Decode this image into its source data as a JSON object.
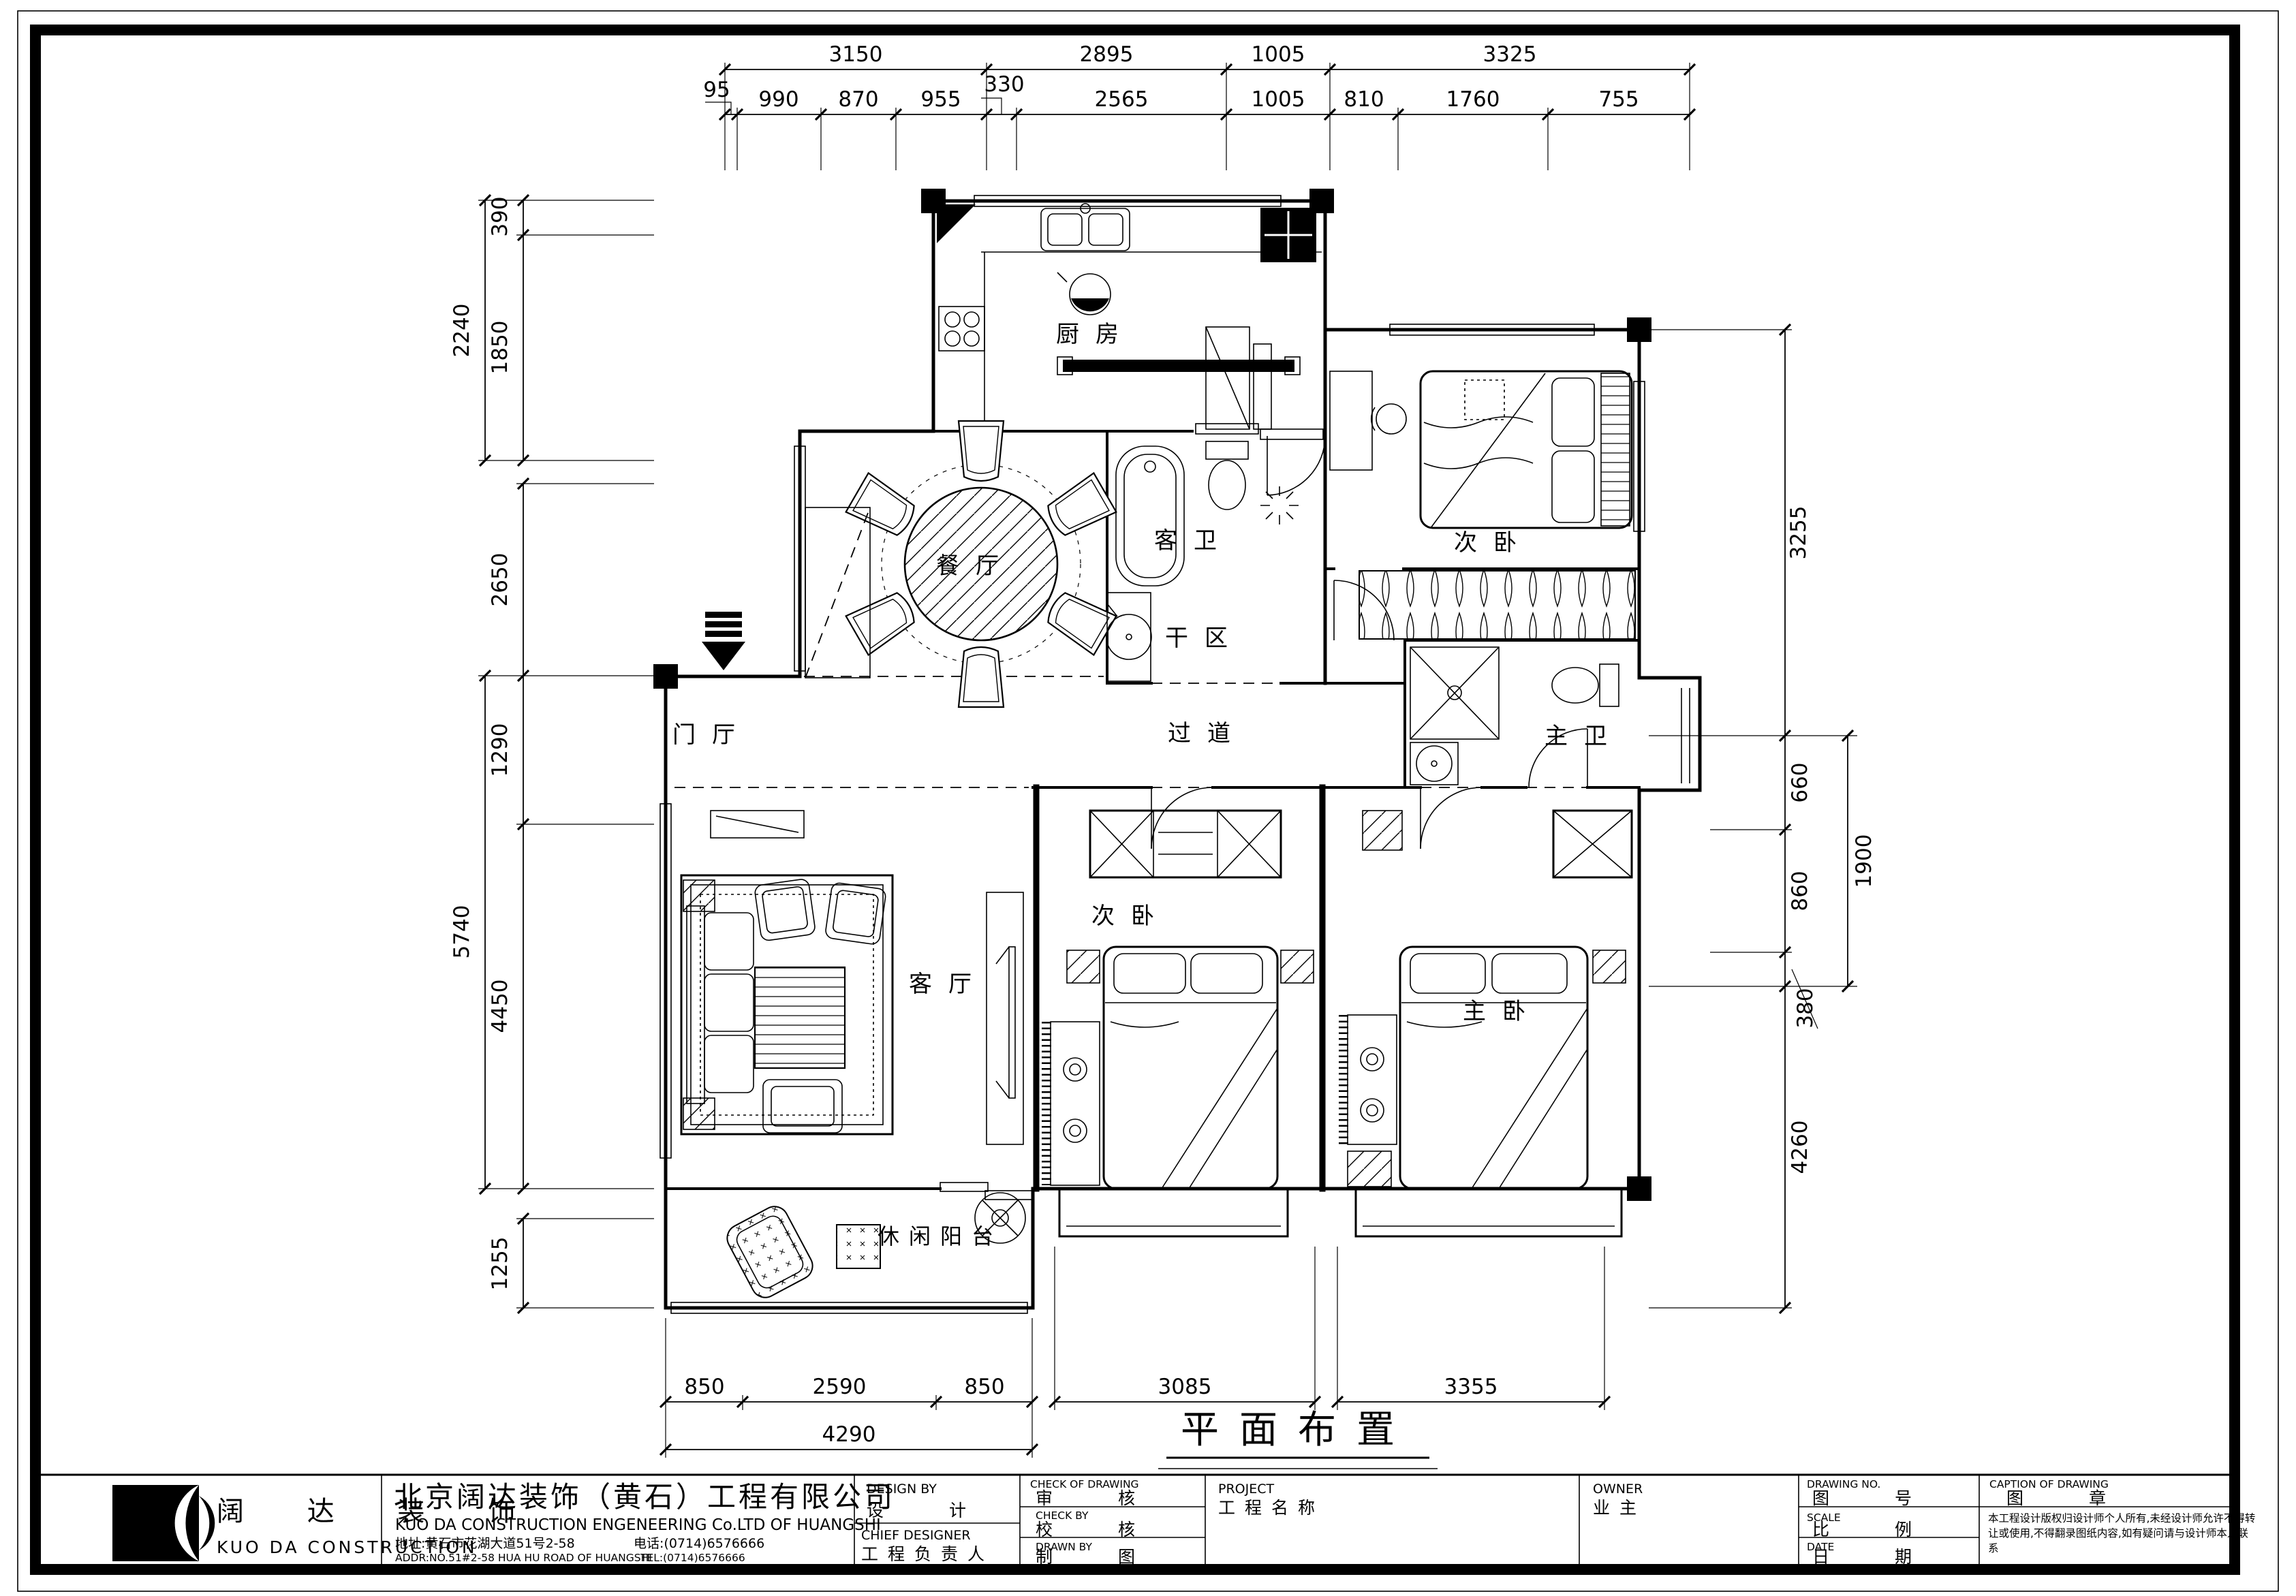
{
  "caption": "平面布置",
  "dims": {
    "top1": [
      "3150",
      "2895",
      "1005",
      "3325"
    ],
    "top2": [
      "95",
      "990",
      "870",
      "955",
      "330",
      "2565",
      "1005",
      "810",
      "1760",
      "755"
    ],
    "left": [
      "390",
      "2240",
      "1850",
      "2650",
      "1290",
      "5740",
      "4450",
      "1255"
    ],
    "right": [
      "3255",
      "660",
      "860",
      "380",
      "1900",
      "4260"
    ],
    "bottom1": [
      "850",
      "2590",
      "850",
      "3085",
      "3355"
    ],
    "bottom2": [
      "4290"
    ]
  },
  "rooms": {
    "kitchen": "厨房",
    "dining": "餐厅",
    "guest_bath": "客卫",
    "dry_area": "干区",
    "bedroom_ne": "次卧",
    "hallway": "过道",
    "foyer": "门厅",
    "master_bath": "主卫",
    "living": "客厅",
    "bedroom_south": "次卧",
    "master_bedroom": "主卧",
    "balcony": "休闲阳台"
  },
  "titleblock": {
    "logo_cn": "阔 达 装 饰",
    "logo_en": "KUO DA CONSTRUCTION",
    "company_cn": "北京阔达装饰（黄石）工程有限公司",
    "company_en": "KUO DA CONSTRUCTION ENGENEERING Co.LTD OF HUANGSHI",
    "address_cn": "地址:黄石市花湖大道51号2-58",
    "phone_cn": "电话:(0714)6576666",
    "address_en": "ADDR:NO.51#2-58 HUA HU ROAD OF HUANGSHI",
    "phone_en": "TEL:(0714)6576666",
    "design_by_en": "DESIGN BY",
    "design_by_cn": "设 计",
    "chief_designer_en": "CHIEF DESIGNER",
    "chief_designer_cn": "工程负责人",
    "check_of_drawing_en": "CHECK OF DRAWING",
    "check_of_drawing_cn": "审 核",
    "check_by_en": "CHECK BY",
    "check_by_cn": "校 核",
    "drawn_by_en": "DRAWN BY",
    "drawn_by_cn": "制 图",
    "project_en": "PROJECT",
    "project_cn": "工程名称",
    "owner_en": "OWNER",
    "owner_cn": "业主",
    "drawing_no_en": "DRAWING NO.",
    "drawing_no_cn": "图 号",
    "scale_en": "SCALE",
    "scale_cn": "比 例",
    "date_en": "DATE",
    "date_cn": "日 期",
    "caption_en": "CAPTION OF DRAWING",
    "caption_cn": "图 章",
    "disclaimer1": "本工程设计版权归设计师个人所有,未经设计师允许不得转",
    "disclaimer2": "让或使用,不得翻录图纸内容,如有疑问请与设计师本人联",
    "disclaimer3": "系"
  }
}
